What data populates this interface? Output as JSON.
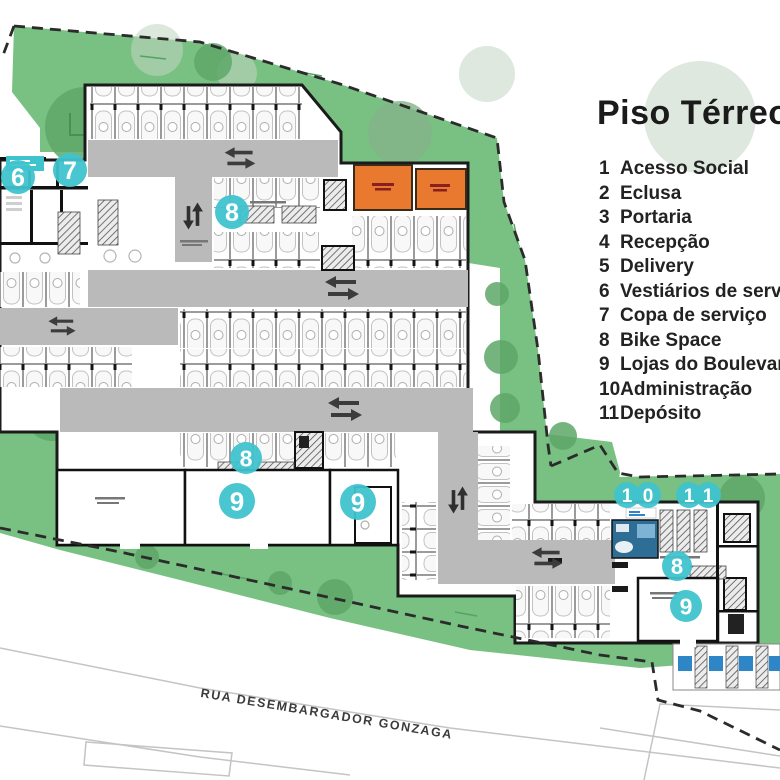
{
  "legend": {
    "title": "Piso Térreo",
    "items": [
      {
        "num": "1",
        "label": "Acesso Social"
      },
      {
        "num": "2",
        "label": "Eclusa"
      },
      {
        "num": "3",
        "label": "Portaria"
      },
      {
        "num": "4",
        "label": "Recepção"
      },
      {
        "num": "5",
        "label": "Delivery"
      },
      {
        "num": "6",
        "label": "Vestiários de serv"
      },
      {
        "num": "7",
        "label": "Copa de serviço"
      },
      {
        "num": "8",
        "label": "Bike Space"
      },
      {
        "num": "9",
        "label": "Lojas do Boulevar"
      },
      {
        "num": "10",
        "label": "Administração"
      },
      {
        "num": "11",
        "label": "Depósito"
      }
    ]
  },
  "street": {
    "name": "RUA DESEMBARGADOR GONZAGA"
  },
  "markers": [
    {
      "label": "6",
      "x": 18,
      "y": 177,
      "r": 17
    },
    {
      "label": "7",
      "x": 70,
      "y": 170,
      "r": 17
    },
    {
      "label": "8",
      "x": 232,
      "y": 212,
      "r": 17
    },
    {
      "label": "8",
      "x": 246,
      "y": 458,
      "r": 16
    },
    {
      "label": "9",
      "x": 237,
      "y": 501,
      "r": 18
    },
    {
      "label": "9",
      "x": 358,
      "y": 502,
      "r": 18
    },
    {
      "label": "1",
      "x": 627,
      "y": 495,
      "r": 13
    },
    {
      "label": "0",
      "x": 648,
      "y": 495,
      "r": 13
    },
    {
      "label": "1",
      "x": 689,
      "y": 495,
      "r": 13
    },
    {
      "label": "1",
      "x": 708,
      "y": 495,
      "r": 13
    },
    {
      "label": "8",
      "x": 677,
      "y": 566,
      "r": 15
    },
    {
      "label": "9",
      "x": 686,
      "y": 606,
      "r": 16
    }
  ],
  "colors": {
    "marker_cyan": "#3FC3CD",
    "site_green": "#79C183",
    "tree_green": "#5EA768",
    "room_orange": "#E8792E",
    "accent_blue": "#2E86C6",
    "wall_dark": "#1B1B1B",
    "aisle_gray": "#BABABA"
  }
}
